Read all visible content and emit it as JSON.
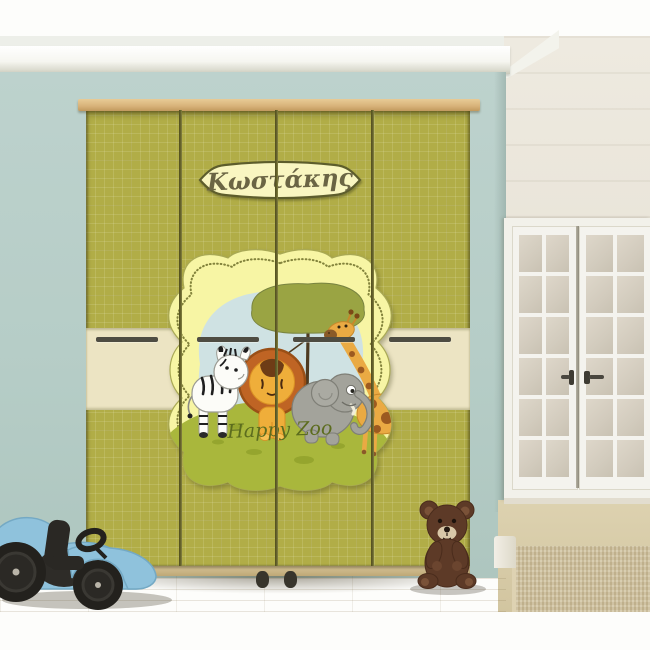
{
  "product": {
    "name_banner": "Κωστάκης",
    "decal_caption": "Happy Zoo"
  },
  "colors": {
    "wardrobe_green": "#b1ad47",
    "wardrobe_band_cream": "#ece4c3",
    "wardrobe_wood_top": "#d7b279",
    "back_wall_teal": "#b6cdc7",
    "right_wall_cream": "#e8e3d7",
    "decal_frame_yellow": "#f7f5a4",
    "decal_sky_blue": "#cfe2e3",
    "decal_hill_green": "#a9b73c",
    "banner_cream": "#f9f6c1",
    "banner_text_olive": "#6b6544",
    "caption_green": "#5c6c1e",
    "toy_car_blue": "#8fc2dc",
    "teddy_brown": "#5d3a27",
    "floor_wood": "#d5c8a3"
  }
}
